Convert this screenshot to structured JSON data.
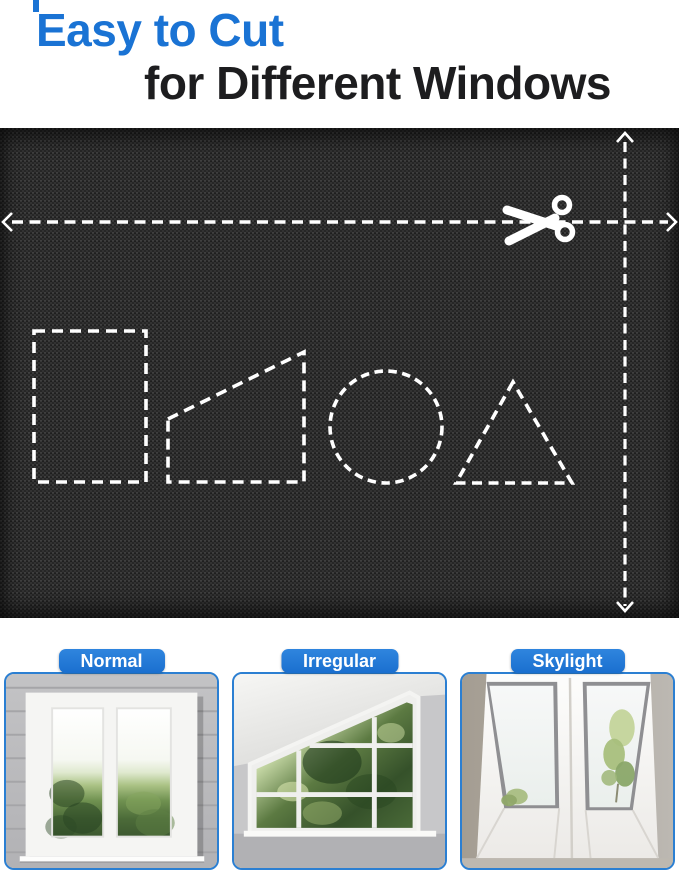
{
  "page": {
    "background": "#ffffff",
    "accent_blue": "#1a73d4"
  },
  "header": {
    "title_line1": "Easy to Cut",
    "title_line2": "for Different Windows"
  },
  "fabric_panel": {
    "fabric_color": "#262626",
    "guide_color": "#ffffff",
    "icons": [
      "scissors-icon",
      "left-arrow-icon",
      "right-arrow-icon",
      "up-arrow-icon",
      "down-arrow-icon"
    ],
    "cut_shapes": [
      "rectangle",
      "trapezoid",
      "circle",
      "triangle"
    ]
  },
  "window_cards": [
    {
      "label": "Normal"
    },
    {
      "label": "Irregular"
    },
    {
      "label": "Skylight"
    }
  ]
}
